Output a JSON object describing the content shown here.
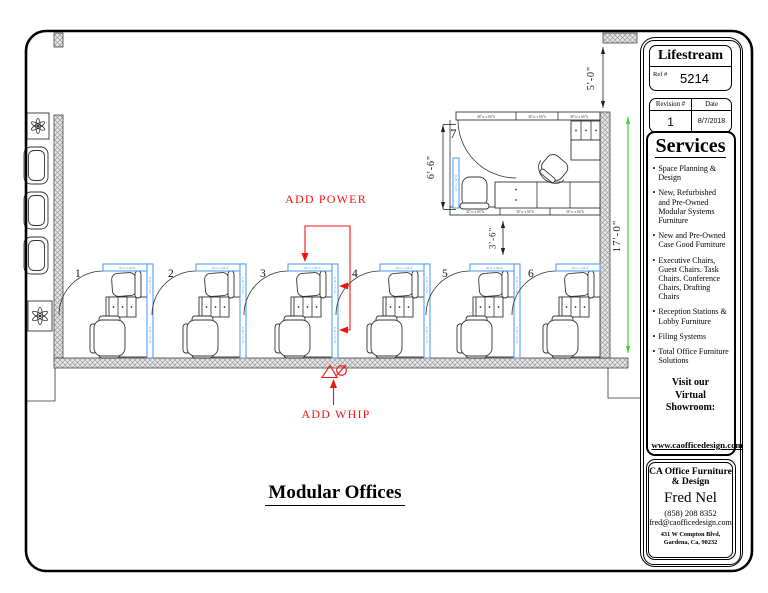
{
  "sheet": {
    "title": "Modular Offices"
  },
  "title_block": {
    "client": "Lifestream",
    "ref_label": "Ref #",
    "ref_number": "5214",
    "revision_label": "Revision #",
    "date_label": "Date",
    "revision_number": "1",
    "date": "8/7/2018",
    "services_heading": "Services",
    "services_items": [
      "Space Planning & Design",
      "New, Refurbished and Pre-Owned Modular Systems Furniture",
      "New and Pre-Owned Case Good Furniture",
      "Executive Chairs, Guest Chairs. Task Chairs. Conference Chairs, Drafting Chairs",
      "Reception Stations & Lobby Furniture",
      "Filing Systems",
      "Total Office Furniture Solutions"
    ],
    "showroom_line1": "Visit our",
    "showroom_line2": "Virtual Showroom:",
    "website": "www.caofficedesign.com",
    "company_line1": "CA Office Furniture",
    "company_line2": "& Design",
    "contact_name": "Fred Nel",
    "phone": "(858) 208 8352",
    "email": "fred@caofficedesign.com",
    "address_line1": "431 W Compton Blvd,",
    "address_line2": "Gardena, Ca, 90232"
  },
  "plan": {
    "office_number": "7",
    "office_top_panels": [
      "48\"w x 66\"h",
      "36\"w x 66\"h",
      "36\"w x 66\"h"
    ],
    "office_bottom_panels": [
      "42\"w x 66\"h",
      "36\"w x 66\"h",
      "36\"w x 66\"h"
    ],
    "cubicle_numbers": [
      "1",
      "2",
      "3",
      "4",
      "5",
      "6"
    ],
    "panel_label": "36\"w x 66\"h",
    "annotations": {
      "add_power": "ADD POWER",
      "add_whip": "ADD WHIP"
    },
    "dimensions": {
      "top_right": "5'-0\"",
      "right_wall": "17'-0\"",
      "office_height": "6'-6\"",
      "office_gap": "3'-6\""
    },
    "colors": {
      "panel_blue": "#55a0ee",
      "annotation_red": "#f01414",
      "dimension_green": "#3ecf3e"
    }
  }
}
